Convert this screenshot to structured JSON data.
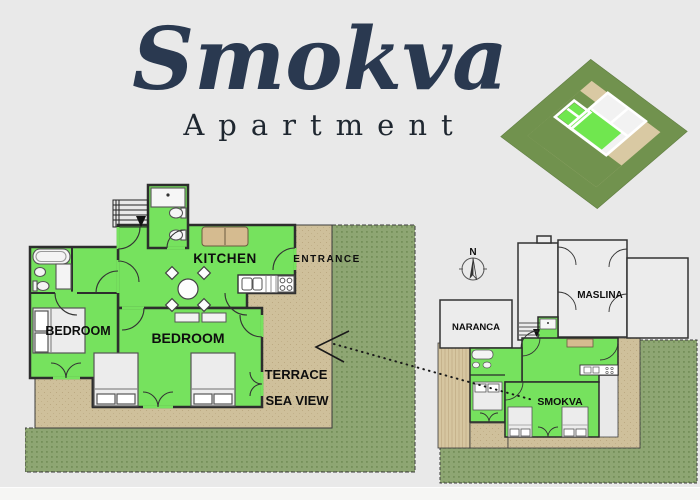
{
  "title": {
    "main": "Smokva",
    "subtitle": "Apartment"
  },
  "main_plan": {
    "rooms": {
      "kitchen": "KITCHEN",
      "bedroom_large": "BEDROOM",
      "bedroom_small": "BEDROOM"
    },
    "areas": {
      "entrance": "ENTRANCE",
      "terrace_line1": "TERRACE",
      "terrace_line2": "SEA VIEW"
    }
  },
  "site_plan": {
    "compass_north": "N",
    "units": {
      "naranca": "NARANCA",
      "maslina": "MASLINA",
      "smokva": "SMOKVA"
    }
  },
  "colors": {
    "background": "#e9e9e9",
    "room_green": "#76e25e",
    "terrace_tan": "#cfc09b",
    "garden_green": "#8ea673",
    "wall": "#2d2d2d",
    "title_navy": "#2a3950"
  }
}
